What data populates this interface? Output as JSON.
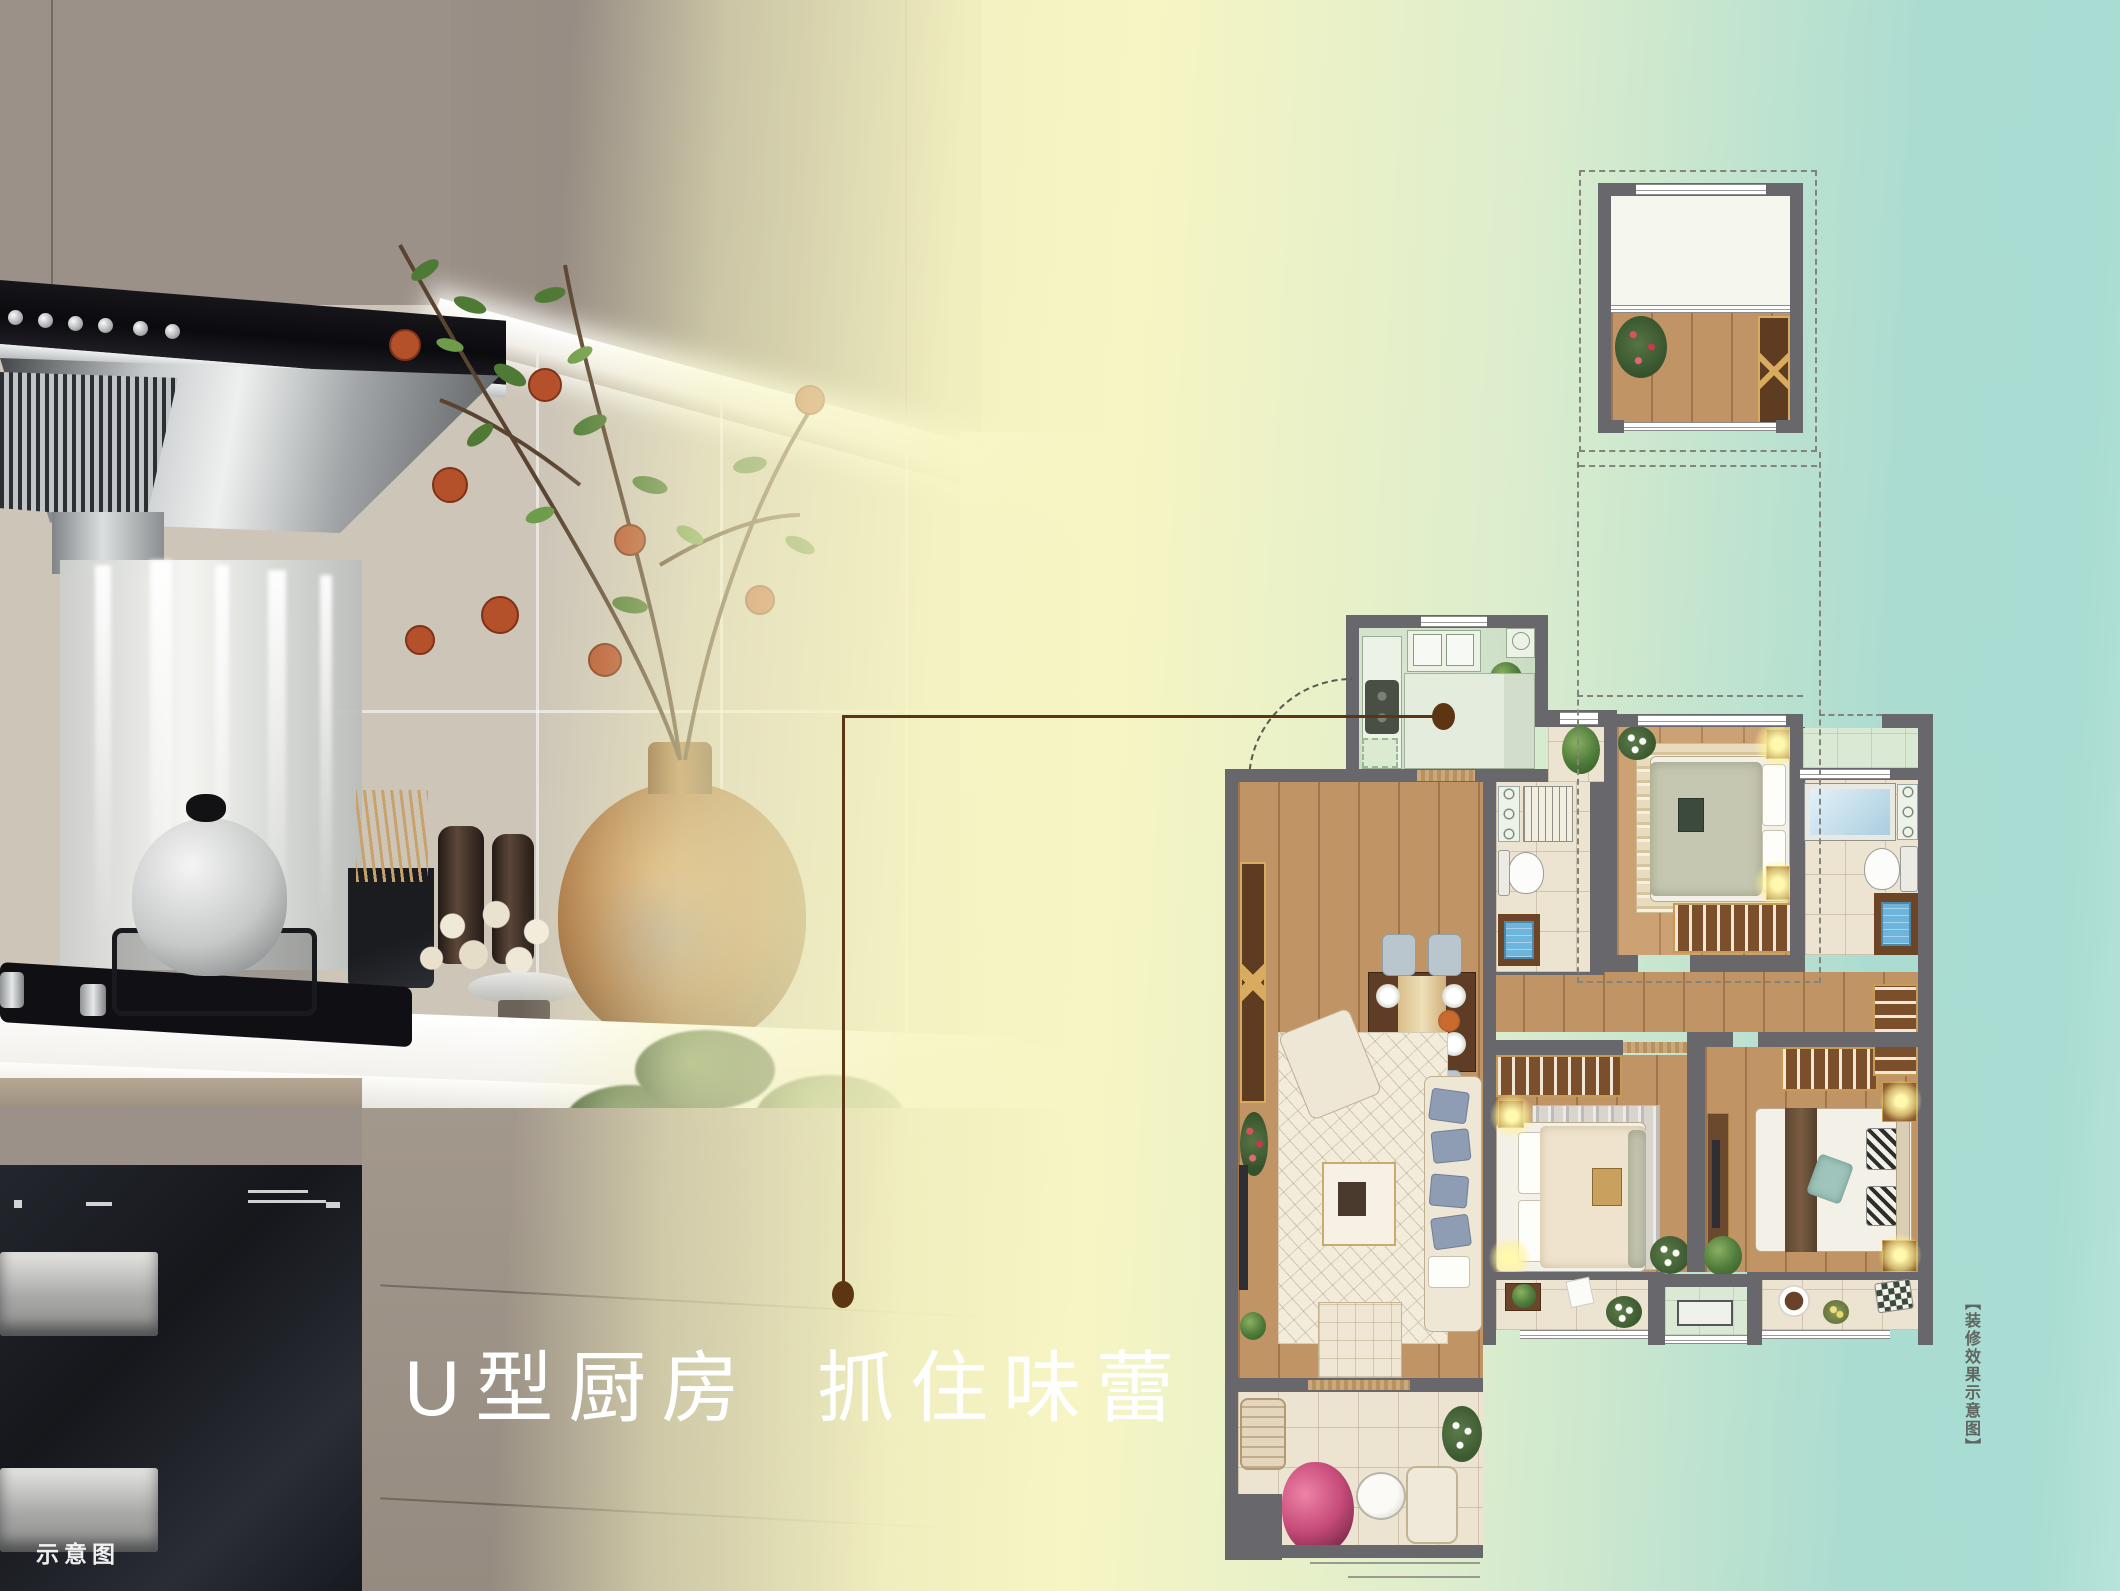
{
  "headline": {
    "text": "U型厨房 抓住味蕾"
  },
  "watermark": {
    "text": "示意图"
  },
  "side_caption": {
    "text": "【装修效果示意图】"
  },
  "colors": {
    "headline_color": "#ffffff",
    "watermark_color": "#ffffff",
    "caption_color": "#5f6661",
    "leader_line": "#5e3513",
    "wall_gray": "#68686c",
    "grad_yellow": "#f7f5c3",
    "grad_green": "#dcedcd",
    "grad_teal": "#a9dcd2",
    "plan_wood": "#bd8d5c",
    "plan_wood_light": "#c89a6a",
    "plan_tile": "#ece3d1",
    "plan_shaft_green": "#d9e9d3"
  }
}
